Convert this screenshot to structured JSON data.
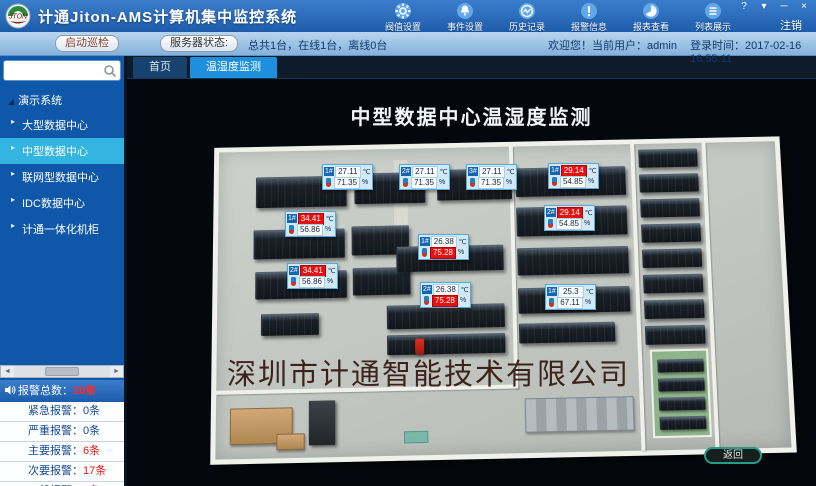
{
  "window": {
    "title": "计通Jiton-AMS计算机集中监控系统",
    "logo_text": "JTON",
    "controls": [
      "?",
      "▾",
      "─",
      "×"
    ],
    "logout_label": "注销"
  },
  "toolbar_icons": [
    {
      "label": "阀值设置",
      "icon": "gear-icon"
    },
    {
      "label": "事件设置",
      "icon": "bell-icon"
    },
    {
      "label": "历史记录",
      "icon": "history-icon"
    },
    {
      "label": "报警信息",
      "icon": "alert-icon"
    },
    {
      "label": "报表查看",
      "icon": "report-icon"
    },
    {
      "label": "列表展示",
      "icon": "list-icon"
    }
  ],
  "status_bar": {
    "patrol_button": "启动巡检",
    "server_status_button": "服务器状态:",
    "server_status_text": "总共1台，在线1台，离线0台",
    "welcome": "欢迎您！当前用户：admin",
    "login_time": "登录时间：2017-02-16 16:55:11"
  },
  "sidebar": {
    "search": {
      "value": "",
      "placeholder": ""
    },
    "tree": {
      "root": "演示系统",
      "children": [
        {
          "label": "大型数据中心",
          "selected": false
        },
        {
          "label": "中型数据中心",
          "selected": true
        },
        {
          "label": "联网型数据中心",
          "selected": false
        },
        {
          "label": "IDC数据中心",
          "selected": false
        },
        {
          "label": "计通一体化机柜",
          "selected": false
        }
      ]
    }
  },
  "alarm_panel": {
    "total_label": "报警总数：",
    "total_value": "26条",
    "rows": [
      {
        "label": "紧急报警：",
        "value": "0条",
        "alarm": false
      },
      {
        "label": "严重报警：",
        "value": "0条",
        "alarm": false
      },
      {
        "label": "主要报警：",
        "value": "6条",
        "alarm": true
      },
      {
        "label": "次要报警：",
        "value": "17条",
        "alarm": true
      },
      {
        "label": "一般报警：",
        "value": "3条",
        "alarm": true
      }
    ]
  },
  "tabs": [
    {
      "label": "首页",
      "active": false
    },
    {
      "label": "温湿度监测",
      "active": true
    }
  ],
  "main": {
    "title": "中型数据中心温湿度监测",
    "watermark": "深圳市计通智能技术有限公司",
    "back_button": "返回"
  },
  "sensors": [
    {
      "id": "1#",
      "temp": "27.11",
      "temp_unit": "℃",
      "hum": "71.35",
      "hum_unit": "%",
      "temp_alarm": false,
      "hum_alarm": false,
      "x": 195,
      "y": 85
    },
    {
      "id": "2#",
      "temp": "27.11",
      "temp_unit": "℃",
      "hum": "71.35",
      "hum_unit": "%",
      "temp_alarm": false,
      "hum_alarm": false,
      "x": 272,
      "y": 85
    },
    {
      "id": "3#",
      "temp": "27.11",
      "temp_unit": "℃",
      "hum": "71.35",
      "hum_unit": "%",
      "temp_alarm": false,
      "hum_alarm": false,
      "x": 339,
      "y": 85
    },
    {
      "id": "1#",
      "temp": "29.14",
      "temp_unit": "℃",
      "hum": "54.85",
      "hum_unit": "%",
      "temp_alarm": true,
      "hum_alarm": false,
      "x": 421,
      "y": 84
    },
    {
      "id": "2#",
      "temp": "29.14",
      "temp_unit": "℃",
      "hum": "54.85",
      "hum_unit": "%",
      "temp_alarm": true,
      "hum_alarm": false,
      "x": 417,
      "y": 126
    },
    {
      "id": "1#",
      "temp": "34.41",
      "temp_unit": "℃",
      "hum": "56.86",
      "hum_unit": "%",
      "temp_alarm": true,
      "hum_alarm": false,
      "x": 158,
      "y": 132
    },
    {
      "id": "2#",
      "temp": "34.41",
      "temp_unit": "℃",
      "hum": "56.86",
      "hum_unit": "%",
      "temp_alarm": true,
      "hum_alarm": false,
      "x": 160,
      "y": 184
    },
    {
      "id": "1#",
      "temp": "26.38",
      "temp_unit": "℃",
      "hum": "75.28",
      "hum_unit": "%",
      "temp_alarm": false,
      "hum_alarm": true,
      "x": 291,
      "y": 155
    },
    {
      "id": "2#",
      "temp": "26.38",
      "temp_unit": "℃",
      "hum": "75.28",
      "hum_unit": "%",
      "temp_alarm": false,
      "hum_alarm": true,
      "x": 293,
      "y": 203
    },
    {
      "id": "1#",
      "temp": "25.3",
      "temp_unit": "℃",
      "hum": "67.11",
      "hum_unit": "%",
      "temp_alarm": false,
      "hum_alarm": false,
      "x": 418,
      "y": 205
    }
  ],
  "colors": {
    "titlebar_blue": "#2e6fbe",
    "selected_tree": "#32b5e0",
    "active_tab": "#1e8fdc",
    "alarm_red": "#e31212",
    "back_border_teal": "#2a9a86"
  }
}
